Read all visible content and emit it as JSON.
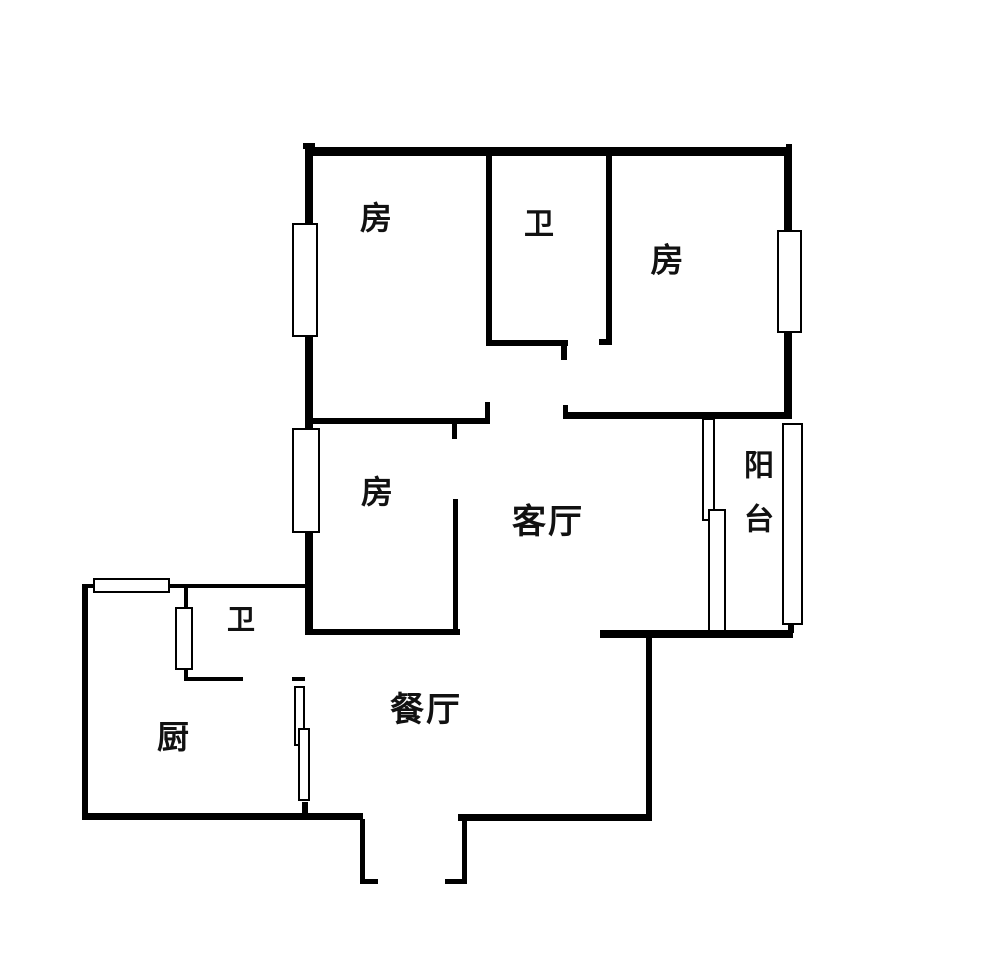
{
  "floorplan": {
    "canvas": {
      "width": 1000,
      "height": 975,
      "background": "#ffffff",
      "line_color": "#000000"
    },
    "rooms": [
      {
        "name": "bedroom-top-left",
        "label": "房",
        "cx": 377,
        "cy": 218,
        "size": 32
      },
      {
        "name": "bathroom-top",
        "label": "卫",
        "cx": 540,
        "cy": 225,
        "size": 30
      },
      {
        "name": "bedroom-top-right",
        "label": "房",
        "cx": 668,
        "cy": 260,
        "size": 33
      },
      {
        "name": "bedroom-middle",
        "label": "房",
        "cx": 378,
        "cy": 492,
        "size": 32
      },
      {
        "name": "living-room",
        "label": "客厅",
        "cx": 548,
        "cy": 522,
        "size": 34
      },
      {
        "name": "balcony",
        "label": "阳台",
        "cx": 755,
        "cy": 503,
        "size": 30,
        "vertical": true
      },
      {
        "name": "bathroom-lower",
        "label": "卫",
        "cx": 242,
        "cy": 620,
        "size": 28
      },
      {
        "name": "kitchen",
        "label": "厨",
        "cx": 174,
        "cy": 737,
        "size": 32
      },
      {
        "name": "dining-room",
        "label": "餐厅",
        "cx": 426,
        "cy": 710,
        "size": 34
      }
    ],
    "walls": [
      {
        "name": "top-wall-nub-left",
        "x": 303,
        "y": 143,
        "w": 12,
        "h": 6
      },
      {
        "name": "top-wall",
        "x": 305,
        "y": 147,
        "w": 487,
        "h": 9
      },
      {
        "name": "top-wall-nub-right",
        "x": 786,
        "y": 144,
        "w": 6,
        "h": 5
      },
      {
        "name": "left-wall",
        "x": 305,
        "y": 147,
        "w": 8,
        "h": 487
      },
      {
        "name": "right-wall",
        "x": 784,
        "y": 147,
        "w": 8,
        "h": 271
      },
      {
        "name": "bed1-bath-divider",
        "x": 486,
        "y": 153,
        "w": 6,
        "h": 190
      },
      {
        "name": "bath-bottom-wall",
        "x": 486,
        "y": 340,
        "w": 82,
        "h": 6
      },
      {
        "name": "bath-bottom-tick",
        "x": 561,
        "y": 346,
        "w": 6,
        "h": 14
      },
      {
        "name": "bath-right-wall",
        "x": 606,
        "y": 153,
        "w": 6,
        "h": 192
      },
      {
        "name": "bath-right-foot",
        "x": 599,
        "y": 339,
        "w": 13,
        "h": 6
      },
      {
        "name": "bed1-bottom-wall",
        "x": 305,
        "y": 418,
        "w": 185,
        "h": 6
      },
      {
        "name": "bed1-bottom-tick-down",
        "x": 452,
        "y": 424,
        "w": 5,
        "h": 15
      },
      {
        "name": "bed1-door-stub",
        "x": 485,
        "y": 402,
        "w": 5,
        "h": 16
      },
      {
        "name": "bed2-bottom-wall",
        "x": 563,
        "y": 412,
        "w": 229,
        "h": 7
      },
      {
        "name": "bed2-bottom-tick-up",
        "x": 563,
        "y": 405,
        "w": 5,
        "h": 7
      },
      {
        "name": "bed3-right-wall",
        "x": 453,
        "y": 499,
        "w": 5,
        "h": 135
      },
      {
        "name": "living-dining-wall-left",
        "x": 305,
        "y": 629,
        "w": 155,
        "h": 6
      },
      {
        "name": "living-dining-wall-right",
        "x": 600,
        "y": 630,
        "w": 193,
        "h": 8
      },
      {
        "name": "balcony-right-stub",
        "x": 788,
        "y": 623,
        "w": 6,
        "h": 10
      },
      {
        "name": "dining-right-wall",
        "x": 646,
        "y": 636,
        "w": 6,
        "h": 184
      },
      {
        "name": "dining-bottom-wall",
        "x": 458,
        "y": 814,
        "w": 194,
        "h": 7
      },
      {
        "name": "kitchen-bottom-wall",
        "x": 82,
        "y": 813,
        "w": 281,
        "h": 7
      },
      {
        "name": "kitchen-left-wall",
        "x": 82,
        "y": 584,
        "w": 6,
        "h": 236
      },
      {
        "name": "kitchen-top-wall",
        "x": 82,
        "y": 584,
        "w": 223,
        "h": 4
      },
      {
        "name": "bath2-left-wall",
        "x": 184,
        "y": 585,
        "w": 4,
        "h": 95
      },
      {
        "name": "bath2-bottom-wall",
        "x": 184,
        "y": 677,
        "w": 59,
        "h": 4
      },
      {
        "name": "bath2-bottom-stub",
        "x": 292,
        "y": 677,
        "w": 13,
        "h": 4
      },
      {
        "name": "dining-left-tick",
        "x": 302,
        "y": 802,
        "w": 6,
        "h": 11
      },
      {
        "name": "entry-left-jamb",
        "x": 360,
        "y": 819,
        "w": 5,
        "h": 65
      },
      {
        "name": "entry-left-tick",
        "x": 360,
        "y": 879,
        "w": 18,
        "h": 5
      },
      {
        "name": "entry-right-jamb",
        "x": 462,
        "y": 814,
        "w": 5,
        "h": 70
      },
      {
        "name": "entry-right-tick",
        "x": 445,
        "y": 879,
        "w": 22,
        "h": 5
      }
    ],
    "windows": [
      {
        "name": "window-bed1-left",
        "x": 292,
        "y": 223,
        "w": 26,
        "h": 114
      },
      {
        "name": "window-bed3-left",
        "x": 292,
        "y": 428,
        "w": 28,
        "h": 105
      },
      {
        "name": "window-bed2-right",
        "x": 777,
        "y": 230,
        "w": 25,
        "h": 103
      },
      {
        "name": "window-balcony-right",
        "x": 782,
        "y": 423,
        "w": 21,
        "h": 202
      },
      {
        "name": "window-kitchen-top",
        "x": 93,
        "y": 578,
        "w": 77,
        "h": 15
      },
      {
        "name": "window-bath2",
        "x": 175,
        "y": 607,
        "w": 18,
        "h": 63
      },
      {
        "name": "door-dining-kitchen-a",
        "x": 294,
        "y": 686,
        "w": 11,
        "h": 60
      },
      {
        "name": "door-dining-kitchen-b",
        "x": 298,
        "y": 728,
        "w": 12,
        "h": 73
      },
      {
        "name": "door-balcony-a",
        "x": 702,
        "y": 418,
        "w": 13,
        "h": 103
      },
      {
        "name": "door-balcony-b",
        "x": 708,
        "y": 509,
        "w": 18,
        "h": 123
      }
    ]
  }
}
